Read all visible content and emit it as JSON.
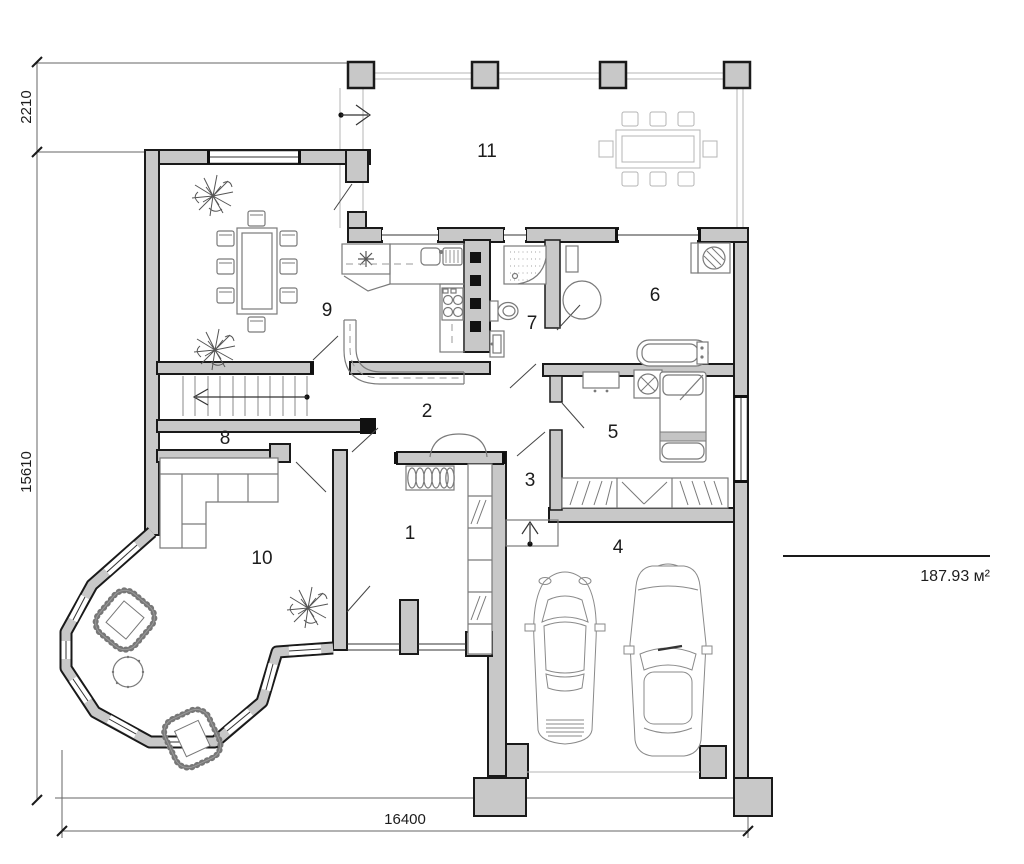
{
  "rooms": [
    {
      "number": "1"
    },
    {
      "number": "2"
    },
    {
      "number": "3"
    },
    {
      "number": "4"
    },
    {
      "number": "5"
    },
    {
      "number": "6"
    },
    {
      "number": "7"
    },
    {
      "number": "8"
    },
    {
      "number": "9"
    },
    {
      "number": "10"
    },
    {
      "number": "11"
    }
  ],
  "dimensions": {
    "terrace_depth": "2210",
    "left_height": "15610",
    "bottom_width": "16400"
  },
  "area_label": "187.93 м²",
  "colors": {
    "wall_fill": "#c8c8c8",
    "outline": "#1a1a1a",
    "furniture_line": "#7a7a7a",
    "dimension_line": "#666666"
  }
}
